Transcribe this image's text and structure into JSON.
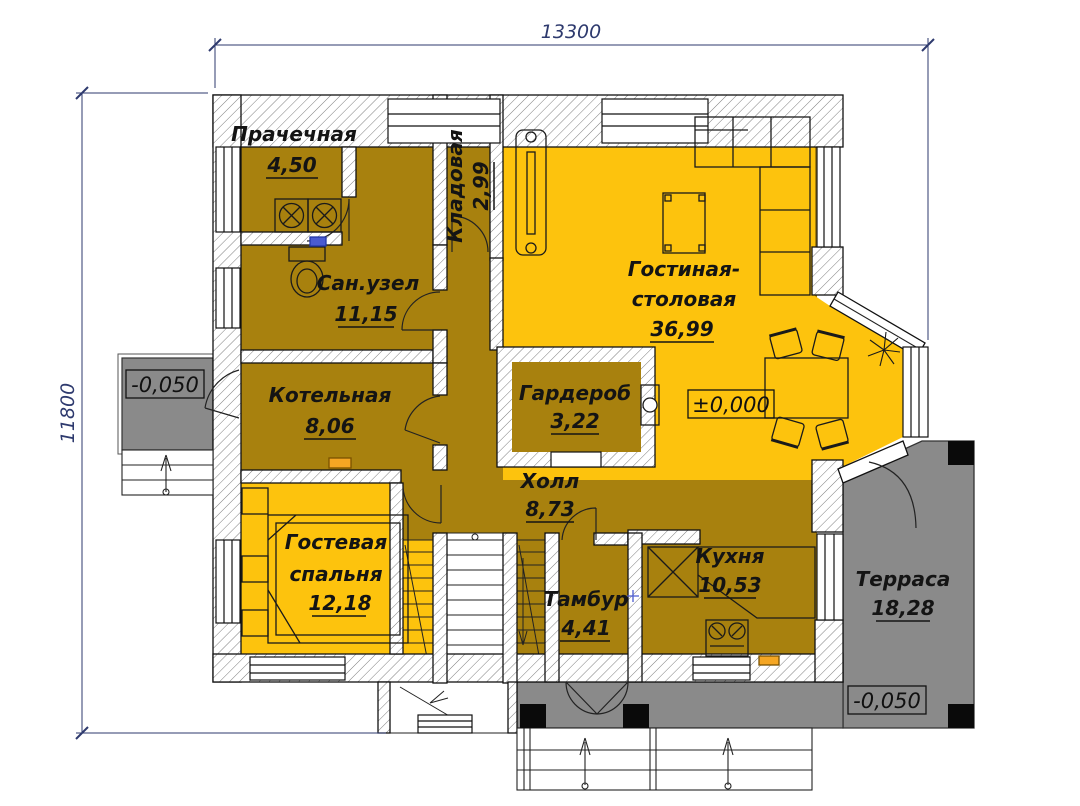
{
  "drawing": {
    "type": "floor-plan",
    "dimensions": {
      "width_mm": "13300",
      "height_mm": "11800"
    },
    "levels": {
      "porch_left": "-0,050",
      "main_floor": "±0,000",
      "terrace": "-0,050"
    },
    "rooms": [
      {
        "name": "Прачечная",
        "area": "4,50"
      },
      {
        "name": "Кладовая",
        "area": "2,99"
      },
      {
        "name": "Сан.узел",
        "area": "11,15"
      },
      {
        "name": "Котельная",
        "area": "8,06"
      },
      {
        "name_line1": "Гостиная-",
        "name_line2": "столовая",
        "area": "36,99"
      },
      {
        "name": "Гардероб",
        "area": "3,22"
      },
      {
        "name": "Холл",
        "area": "8,73"
      },
      {
        "name_line1": "Гостевая",
        "name_line2": "спальня",
        "area": "12,18"
      },
      {
        "name": "Тамбур",
        "area": "4,41"
      },
      {
        "name": "Кухня",
        "area": "10,53"
      },
      {
        "name": "Терраса",
        "area": "18,28"
      }
    ],
    "colors": {
      "living_yellow": "#FDC30D",
      "service_gold": "#A8810E",
      "outdoor_grey": "#8A8A8A",
      "dim_blue": "#2e3a6e",
      "marker_blue": "#4a5bd0"
    }
  }
}
